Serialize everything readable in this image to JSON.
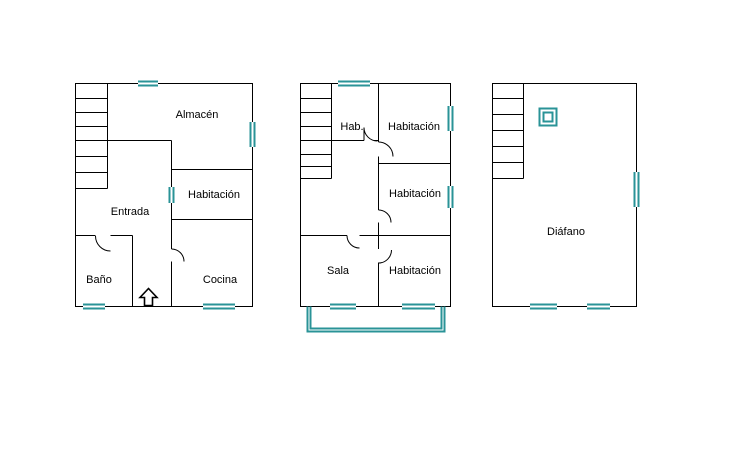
{
  "colors": {
    "background": "#ffffff",
    "wall": "#000000",
    "window": "#2a9397"
  },
  "plans": [
    {
      "name": "left-floor-plan",
      "rooms": [
        {
          "label": "Almacén"
        },
        {
          "label": "Habitación"
        },
        {
          "label": "Entrada"
        },
        {
          "label": "Baño"
        },
        {
          "label": "Cocina"
        }
      ],
      "icons": {
        "entrance_arrow": "hollow-up-arrow"
      }
    },
    {
      "name": "middle-floor-plan",
      "rooms": [
        {
          "label": "Hab."
        },
        {
          "label": "Habitación"
        },
        {
          "label": "Habitación"
        },
        {
          "label": "Sala"
        },
        {
          "label": "Habitación"
        }
      ],
      "icons": {
        "balcony": "double-teal-rectangle"
      }
    },
    {
      "name": "right-floor-plan",
      "rooms": [
        {
          "label": "Diáfano"
        }
      ],
      "icons": {
        "skylight": "double-teal-square"
      }
    }
  ]
}
